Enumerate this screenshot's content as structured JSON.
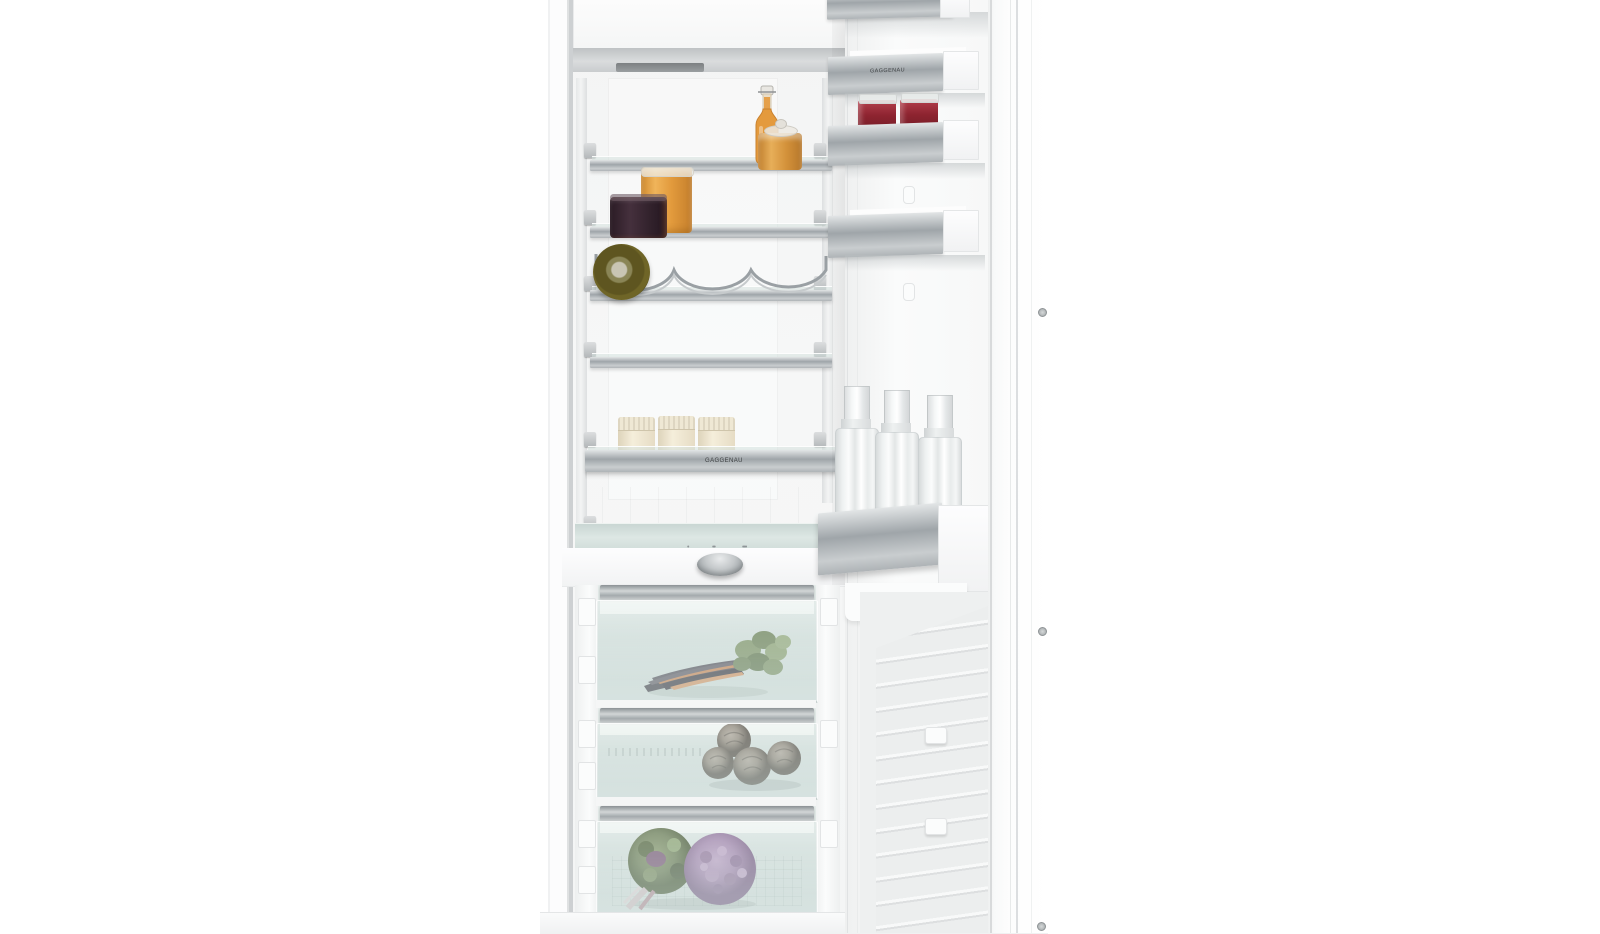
{
  "scene": {
    "type": "appliance product photograph",
    "subject": "built-in single-door refrigerator, door open, interior stocked with food",
    "brand": "GAGGENAU",
    "background_color": "#ffffff"
  },
  "interior": {
    "shelf_logo": "GAGGENAU",
    "shelves": [
      {
        "items": [
          "swing-top bottle of orange cordial",
          "small amber preserve jar"
        ]
      },
      {
        "items": [
          "jar of orange preserve",
          "jar of dark berry jam"
        ]
      },
      {
        "items": [
          "green wine bottle lying on chrome wine rack"
        ]
      },
      {
        "items": []
      },
      {
        "items": [
          "three cream ceramic jars with ribbed lids"
        ]
      }
    ],
    "humidity_control": {
      "control": "round aluminum humidity knob",
      "icon_labels": [
        "•",
        "••",
        "•••"
      ]
    },
    "drawers": [
      {
        "contents": "bunch of purple carrots with green tops"
      },
      {
        "contents": "four artichokes"
      },
      {
        "contents": "purple cauliflower and flowering kale"
      }
    ]
  },
  "door": {
    "bin_logo": "GAGGENAU",
    "bins": [
      {
        "contents": "empty aluminum bin (top, cropped)"
      },
      {
        "contents": "empty aluminum bin with brand logo"
      },
      {
        "contents": "two jars of red jam"
      },
      {
        "contents": "empty aluminum bin"
      },
      {
        "contents": "three clear glass water bottles in bottle bin"
      }
    ]
  },
  "colors": {
    "aluminum": "#aab0b4",
    "glass_tint": "#d9e4e1",
    "jam_red": "#8e2430",
    "preserve_orange": "#e7a03c",
    "wine_olive": "#5e5520",
    "ceramic_cream": "#ece4d0",
    "carrot_purple": "#46404a",
    "carrot_orange": "#d98a52",
    "greens": "#7d9464",
    "cabbage_purple": "#a284ae",
    "artichoke_gray": "#8a8076"
  }
}
